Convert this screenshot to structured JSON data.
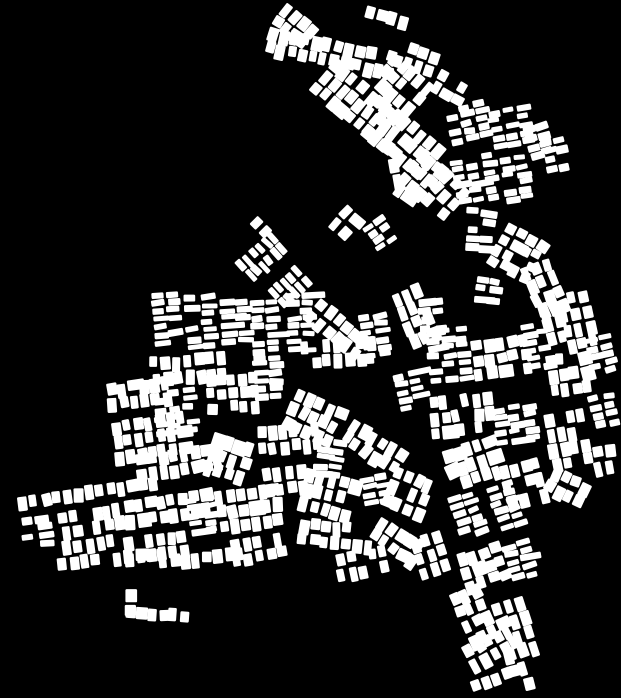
{
  "map": {
    "title": "figure-ground-parcel-map",
    "width": 621,
    "height": 698,
    "background_color": "#000000",
    "parcel_color": "#ffffff",
    "parcel_corner_radius": 1.3,
    "seed": 1337,
    "defaults": {
      "w": 9,
      "h": 13,
      "gx": 2,
      "gy": 2
    },
    "jitter": {
      "size": 0.38,
      "pos": 1.5,
      "skip": 0.055,
      "wide_chance": 0.08,
      "wide_factor": 1.6,
      "rot_chance": 0.3,
      "rot_max": 7
    },
    "block_fields": [
      "x",
      "y",
      "angle",
      "rows",
      "cols",
      "parcel_w",
      "parcel_h"
    ],
    "blocks": [
      [
        287,
        3,
        38,
        2,
        4
      ],
      [
        270,
        26,
        12,
        2,
        12
      ],
      [
        368,
        6,
        15,
        1,
        5
      ],
      [
        400,
        40,
        18,
        2,
        4
      ],
      [
        336,
        58,
        40,
        3,
        9
      ],
      [
        395,
        52,
        40,
        2,
        5
      ],
      [
        383,
        78,
        40,
        2,
        4
      ],
      [
        388,
        100,
        40,
        3,
        8
      ],
      [
        424,
        148,
        42,
        3,
        6
      ],
      [
        388,
        160,
        -10,
        2,
        1,
        10,
        15
      ],
      [
        398,
        183,
        35,
        1,
        2
      ],
      [
        346,
        205,
        40,
        2,
        2
      ],
      [
        362,
        228,
        -35,
        4,
        2,
        11,
        6
      ],
      [
        442,
        70,
        30,
        2,
        3,
        9,
        11
      ],
      [
        443,
        108,
        -12,
        5,
        3,
        13,
        6
      ],
      [
        487,
        112,
        -10,
        5,
        3,
        13,
        6
      ],
      [
        450,
        160,
        -10,
        6,
        3,
        13,
        6
      ],
      [
        500,
        158,
        -8,
        6,
        2,
        13,
        6
      ],
      [
        522,
        128,
        -15,
        4,
        2,
        12,
        7
      ],
      [
        540,
        140,
        -12,
        4,
        2,
        12,
        7
      ],
      [
        468,
        208,
        3,
        5,
        2,
        12,
        7
      ],
      [
        508,
        222,
        28,
        4,
        4,
        10,
        10
      ],
      [
        520,
        268,
        -22,
        4,
        3
      ],
      [
        476,
        276,
        8,
        3,
        2,
        12,
        7
      ],
      [
        538,
        305,
        -15,
        3,
        2
      ],
      [
        257,
        217,
        45,
        1,
        2
      ],
      [
        270,
        232,
        48,
        6,
        2,
        12,
        6
      ],
      [
        295,
        265,
        48,
        5,
        2,
        12,
        6
      ],
      [
        150,
        292,
        -4,
        7,
        2,
        14,
        6
      ],
      [
        184,
        296,
        -4,
        7,
        2,
        14,
        6
      ],
      [
        219,
        300,
        -4,
        6,
        2,
        14,
        6
      ],
      [
        150,
        358,
        -5,
        2,
        7
      ],
      [
        152,
        392,
        -6,
        6,
        3,
        13,
        6
      ],
      [
        205,
        375,
        -4,
        3,
        5,
        9,
        12
      ],
      [
        105,
        385,
        -8,
        2,
        6
      ],
      [
        110,
        422,
        -8,
        3,
        7
      ],
      [
        135,
        455,
        -8,
        2,
        8
      ],
      [
        215,
        432,
        18,
        3,
        4
      ],
      [
        250,
        300,
        -3,
        8,
        2,
        13,
        6
      ],
      [
        285,
        292,
        -3,
        8,
        2,
        13,
        6
      ],
      [
        322,
        298,
        40,
        2,
        6
      ],
      [
        300,
        342,
        -4,
        2,
        7
      ],
      [
        253,
        362,
        -3,
        5,
        2,
        13,
        6
      ],
      [
        298,
        388,
        24,
        3,
        5
      ],
      [
        256,
        428,
        -5,
        2,
        6
      ],
      [
        318,
        438,
        8,
        5,
        2,
        13,
        6
      ],
      [
        358,
        315,
        -8,
        6,
        2,
        13,
        6
      ],
      [
        390,
        295,
        -22,
        4,
        3
      ],
      [
        355,
        418,
        33,
        2,
        6
      ],
      [
        392,
        375,
        -12,
        5,
        2,
        13,
        6
      ],
      [
        418,
        300,
        -6,
        4,
        2,
        12,
        7
      ],
      [
        425,
        330,
        -5,
        7,
        3,
        13,
        6
      ],
      [
        470,
        342,
        -8,
        3,
        5,
        10,
        12
      ],
      [
        520,
        326,
        -10,
        6,
        2,
        13,
        6
      ],
      [
        556,
        296,
        -12,
        4,
        3
      ],
      [
        545,
        356,
        -8,
        3,
        4
      ],
      [
        584,
        340,
        -12,
        5,
        2,
        13,
        6
      ],
      [
        428,
        398,
        -6,
        3,
        6
      ],
      [
        492,
        408,
        -8,
        5,
        3,
        13,
        6
      ],
      [
        543,
        416,
        -10,
        4,
        4
      ],
      [
        588,
        396,
        -12,
        4,
        2,
        12,
        7
      ],
      [
        440,
        452,
        -18,
        3,
        5
      ],
      [
        498,
        468,
        -14,
        3,
        4
      ],
      [
        554,
        466,
        26,
        2,
        4
      ],
      [
        592,
        448,
        -10,
        2,
        2
      ],
      [
        308,
        468,
        14,
        3,
        5
      ],
      [
        360,
        478,
        -10,
        4,
        2,
        13,
        6
      ],
      [
        396,
        466,
        22,
        3,
        4
      ],
      [
        300,
        518,
        6,
        2,
        7
      ],
      [
        382,
        516,
        32,
        2,
        5
      ],
      [
        334,
        556,
        -12,
        2,
        5
      ],
      [
        410,
        540,
        -18,
        3,
        3
      ],
      [
        18,
        496,
        -8,
        1,
        13
      ],
      [
        20,
        518,
        -8,
        4,
        2,
        13,
        7
      ],
      [
        58,
        512,
        -8,
        3,
        5
      ],
      [
        112,
        502,
        -8,
        2,
        9
      ],
      [
        122,
        538,
        -8,
        2,
        6
      ],
      [
        186,
        498,
        -8,
        5,
        2,
        13,
        6
      ],
      [
        214,
        492,
        -8,
        3,
        6
      ],
      [
        58,
        558,
        -6,
        1,
        10
      ],
      [
        158,
        556,
        -6,
        1,
        8
      ],
      [
        230,
        540,
        -10,
        2,
        5
      ],
      [
        124,
        590,
        0,
        2,
        1,
        10,
        12
      ],
      [
        126,
        606,
        4,
        1,
        6
      ],
      [
        262,
        470,
        -8,
        2,
        4
      ],
      [
        448,
        498,
        -18,
        6,
        2,
        13,
        6
      ],
      [
        486,
        488,
        -18,
        6,
        2,
        13,
        6
      ],
      [
        455,
        556,
        -18,
        3,
        4,
        10,
        12
      ],
      [
        502,
        546,
        -16,
        5,
        2,
        13,
        6
      ],
      [
        448,
        596,
        -24,
        4,
        3
      ],
      [
        492,
        606,
        -18,
        4,
        3
      ],
      [
        462,
        648,
        -28,
        2,
        5
      ],
      [
        504,
        652,
        -14,
        3,
        2
      ],
      [
        470,
        682,
        -20,
        1,
        4
      ]
    ]
  }
}
